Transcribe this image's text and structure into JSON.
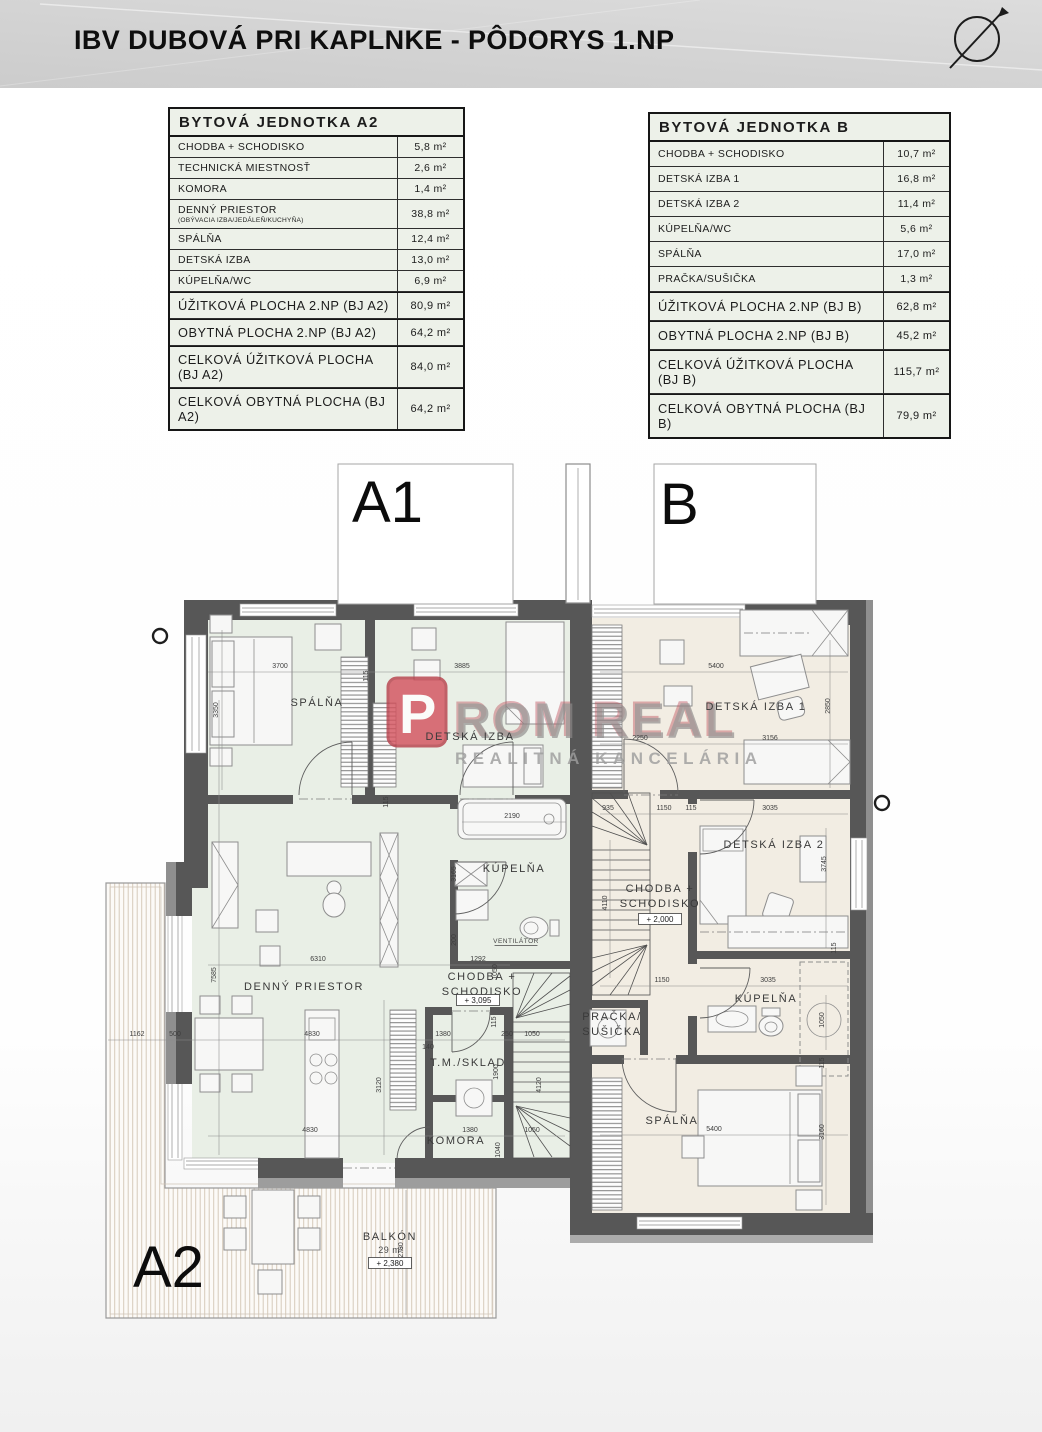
{
  "header": {
    "title": "IBV DUBOVÁ PRI KAPLNKE - PÔDORYS 1.NP"
  },
  "tables": {
    "a2": {
      "title": "BYTOVÁ JEDNOTKA A2",
      "rows": [
        {
          "label": "CHODBA + SCHODISKO",
          "value": "5,8 m²"
        },
        {
          "label": "TECHNICKÁ MIESTNOSŤ",
          "value": "2,6 m²"
        },
        {
          "label": "KOMORA",
          "value": "1,4 m²"
        },
        {
          "label": "DENNÝ PRIESTOR",
          "sublabel": "(OBÝVACIA IZBA/JEDÁLEŇ/KUCHYŇA)",
          "value": "38,8 m²"
        },
        {
          "label": "SPÁLŇA",
          "value": "12,4 m²"
        },
        {
          "label": "DETSKÁ IZBA",
          "value": "13,0 m²"
        },
        {
          "label": "KÚPELŇA/WC",
          "value": "6,9 m²"
        },
        {
          "label": "ÚŽITKOVÁ PLOCHA 2.NP (BJ A2)",
          "value": "80,9 m²",
          "section": true
        },
        {
          "label": "OBYTNÁ PLOCHA 2.NP (BJ A2)",
          "value": "64,2 m²",
          "section": true
        },
        {
          "label": "CELKOVÁ ÚŽITKOVÁ PLOCHA (BJ A2)",
          "value": "84,0 m²",
          "section": true
        },
        {
          "label": "CELKOVÁ OBYTNÁ PLOCHA (BJ A2)",
          "value": "64,2 m²",
          "section": true
        }
      ]
    },
    "b": {
      "title": "BYTOVÁ JEDNOTKA B",
      "rows": [
        {
          "label": "CHODBA + SCHODISKO",
          "value": "10,7 m²"
        },
        {
          "label": "DETSKÁ IZBA 1",
          "value": "16,8 m²"
        },
        {
          "label": "DETSKÁ IZBA 2",
          "value": "11,4 m²"
        },
        {
          "label": "KÚPELŇA/WC",
          "value": "5,6 m²"
        },
        {
          "label": "SPÁLŇA",
          "value": "17,0 m²"
        },
        {
          "label": "PRAČKA/SUŠIČKA",
          "value": "1,3 m²"
        },
        {
          "label": "ÚŽITKOVÁ PLOCHA 2.NP (BJ B)",
          "value": "62,8 m²",
          "section": true
        },
        {
          "label": "OBYTNÁ PLOCHA 2.NP (BJ B)",
          "value": "45,2 m²",
          "section": true
        },
        {
          "label": "CELKOVÁ ÚŽITKOVÁ PLOCHA (BJ B)",
          "value": "115,7 m²",
          "section": true
        },
        {
          "label": "CELKOVÁ OBYTNÁ PLOCHA (BJ B)",
          "value": "79,9 m²",
          "section": true
        }
      ]
    }
  },
  "watermark": {
    "letter": "P",
    "name": "ROM REAL",
    "subtitle": "REALITNÁ KANCELÁRIA",
    "red": "#c9505c",
    "gray": "#9b9b9b"
  },
  "plan": {
    "colors": {
      "wall": "#575757",
      "unit_a_floor": "#e9efe6",
      "unit_b_floor": "#f2ede3",
      "balcony_hatch": "#d6cabb"
    },
    "unit_labels": [
      {
        "t": "A1",
        "x": 352,
        "y": 522
      },
      {
        "t": "B",
        "x": 660,
        "y": 524
      },
      {
        "t": "A2",
        "x": 133,
        "y": 1287
      }
    ],
    "rooms": [
      {
        "lines": [
          "SPÁLŇA"
        ],
        "x": 317,
        "y": 706
      },
      {
        "lines": [
          "DETSKÁ IZBA"
        ],
        "x": 470,
        "y": 740
      },
      {
        "lines": [
          "KÚPELŇA"
        ],
        "x": 514,
        "y": 872
      },
      {
        "lines": [
          "DENNÝ PRIESTOR"
        ],
        "x": 304,
        "y": 990
      },
      {
        "lines": [
          "CHODBA +",
          "SCHODISKO"
        ],
        "x": 482,
        "y": 980
      },
      {
        "lines": [
          "T.M./SKLAD"
        ],
        "x": 468,
        "y": 1066
      },
      {
        "lines": [
          "KOMORA"
        ],
        "x": 456,
        "y": 1144
      },
      {
        "lines": [
          "DETSKÁ IZBA 1"
        ],
        "x": 756,
        "y": 710
      },
      {
        "lines": [
          "DETSKÁ IZBA 2"
        ],
        "x": 774,
        "y": 848
      },
      {
        "lines": [
          "CHODBA +",
          "SCHODISKO"
        ],
        "x": 660,
        "y": 892
      },
      {
        "lines": [
          "KÚPELŇA"
        ],
        "x": 766,
        "y": 1002
      },
      {
        "lines": [
          "PRAČKA/",
          "SUŠIČKA"
        ],
        "x": 612,
        "y": 1020
      },
      {
        "lines": [
          "SPÁLŇA"
        ],
        "x": 672,
        "y": 1124
      },
      {
        "lines": [
          "BALKÓN"
        ],
        "x": 390,
        "y": 1240
      }
    ],
    "levels": [
      {
        "t": "+ 3,095",
        "x": 478,
        "y": 1003
      },
      {
        "t": "+ 2,000",
        "x": 660,
        "y": 922
      },
      {
        "t": "+ 2,380",
        "x": 390,
        "y": 1266
      }
    ],
    "misc": [
      {
        "t": "29 m²",
        "x": 391,
        "y": 1253,
        "s": 9
      },
      {
        "t": "VENTILÁTOR",
        "x": 516,
        "y": 943,
        "s": 6.5,
        "u": true
      }
    ],
    "dims": [
      {
        "t": "3700",
        "x": 280,
        "y": 668
      },
      {
        "t": "115",
        "x": 368,
        "y": 676,
        "r": 1
      },
      {
        "t": "3885",
        "x": 462,
        "y": 668
      },
      {
        "t": "3350",
        "x": 218,
        "y": 710,
        "r": 1
      },
      {
        "t": "5400",
        "x": 716,
        "y": 668
      },
      {
        "t": "2250",
        "x": 640,
        "y": 740
      },
      {
        "t": "3156",
        "x": 770,
        "y": 740
      },
      {
        "t": "2850",
        "x": 830,
        "y": 706,
        "r": 1
      },
      {
        "t": "6310",
        "x": 318,
        "y": 961
      },
      {
        "t": "1292",
        "x": 478,
        "y": 961
      },
      {
        "t": "1050",
        "x": 497,
        "y": 972,
        "r": 1
      },
      {
        "t": "2190",
        "x": 512,
        "y": 818
      },
      {
        "t": "3165",
        "x": 456,
        "y": 874,
        "r": 1
      },
      {
        "t": "200",
        "x": 456,
        "y": 940,
        "r": 1
      },
      {
        "t": "7585",
        "x": 216,
        "y": 975,
        "r": 1
      },
      {
        "t": "1162",
        "x": 137,
        "y": 1036
      },
      {
        "t": "500",
        "x": 175,
        "y": 1036
      },
      {
        "t": "115",
        "x": 388,
        "y": 802,
        "r": 1
      },
      {
        "t": "4830",
        "x": 312,
        "y": 1036
      },
      {
        "t": "1380",
        "x": 443,
        "y": 1036
      },
      {
        "t": "140",
        "x": 428,
        "y": 1049
      },
      {
        "t": "250",
        "x": 507,
        "y": 1036
      },
      {
        "t": "1050",
        "x": 532,
        "y": 1036
      },
      {
        "t": "115",
        "x": 496,
        "y": 1022,
        "r": 1
      },
      {
        "t": "3120",
        "x": 381,
        "y": 1085,
        "r": 1
      },
      {
        "t": "1900",
        "x": 498,
        "y": 1072,
        "r": 1
      },
      {
        "t": "4120",
        "x": 541,
        "y": 1085,
        "r": 1
      },
      {
        "t": "4830",
        "x": 310,
        "y": 1132
      },
      {
        "t": "1380",
        "x": 470,
        "y": 1132
      },
      {
        "t": "1040",
        "x": 500,
        "y": 1150,
        "r": 1
      },
      {
        "t": "1050",
        "x": 532,
        "y": 1132
      },
      {
        "t": "935",
        "x": 608,
        "y": 810
      },
      {
        "t": "1150",
        "x": 664,
        "y": 810
      },
      {
        "t": "115",
        "x": 691,
        "y": 810
      },
      {
        "t": "3035",
        "x": 770,
        "y": 810
      },
      {
        "t": "3745",
        "x": 826,
        "y": 864,
        "r": 1
      },
      {
        "t": "4110",
        "x": 607,
        "y": 903,
        "r": 1
      },
      {
        "t": "1150",
        "x": 662,
        "y": 982
      },
      {
        "t": "3035",
        "x": 768,
        "y": 982
      },
      {
        "t": "1050",
        "x": 824,
        "y": 1020,
        "r": 1
      },
      {
        "t": "115",
        "x": 836,
        "y": 948,
        "r": 1
      },
      {
        "t": "5400",
        "x": 714,
        "y": 1131
      },
      {
        "t": "3160",
        "x": 824,
        "y": 1132,
        "r": 1
      },
      {
        "t": "115",
        "x": 824,
        "y": 1063,
        "r": 1
      },
      {
        "t": "2780",
        "x": 403,
        "y": 1250,
        "r": 1
      }
    ]
  }
}
